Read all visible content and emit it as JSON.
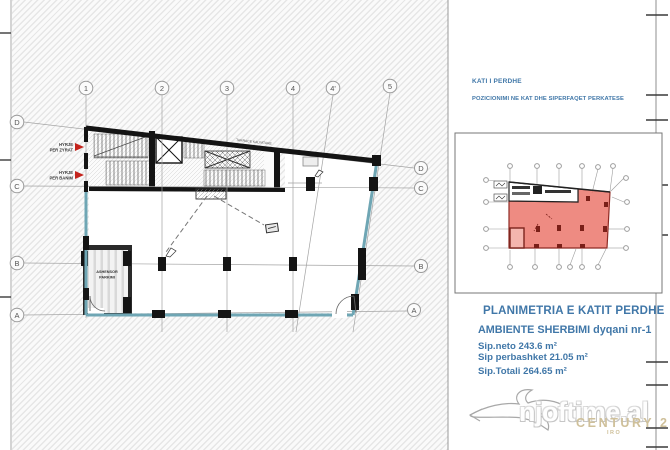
{
  "header": {
    "floor_label": "KATI I PERDHE",
    "position_label": "POZICIONIMI NE KAT DHE SIPERFAQET PERKATESE"
  },
  "summary": {
    "title": "PLANIMETRIA E KATIT PERDHE",
    "subtitle": "AMBIENTE SHERBIMI dyqani nr-1",
    "area_net": "Sip.neto 243.6 m²",
    "area_shared": "Sip perbashket 21.05 m²",
    "area_total": "Sip.Totali 264.65 m²"
  },
  "grid": {
    "top": [
      "1",
      "2",
      "3",
      "4",
      "4'",
      "5"
    ],
    "left": [
      "D",
      "C",
      "B",
      "A"
    ],
    "right": [
      "D",
      "C",
      "B",
      "A"
    ]
  },
  "plan_labels": {
    "entrance_offices_line1": "HYRJE",
    "entrance_offices_line2": "PER ZYRAT",
    "entrance_housing_line1": "HYRJE",
    "entrance_housing_line2": "PER BANIM",
    "parking_lift_line1": "ASHENSOR",
    "parking_lift_line2": "PARKIMI",
    "terrace": "TARRACE KALIMTARE"
  },
  "watermark": {
    "site": "njoftime.al",
    "brand": "CENTURY 21",
    "brand_sub": "IRO"
  },
  "colors": {
    "accent_blue": "#4077a8",
    "glass_teal": "#6fa6b4",
    "highlight_red": "#e96a5f",
    "brand_gold": "#cfc09a",
    "arrow_red": "#c4241d"
  }
}
